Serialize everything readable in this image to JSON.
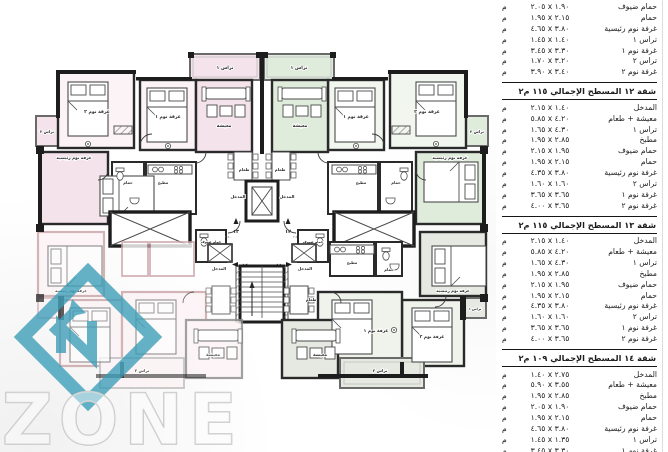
{
  "watermark": {
    "brand": "ZONE",
    "accent": "#3a9db8"
  },
  "plan": {
    "rooms": {
      "bed2": "غرفة نوم ٢",
      "bed1": "غرفة نوم ١",
      "master": "غرفة نوم رئيسية",
      "living": "معيشة",
      "dining": "طعام",
      "kitchen": "مطبخ",
      "bath": "حمام",
      "guest_bath": "حمام ضيوف",
      "entrance": "المدخل",
      "terrace1": "تراس ١",
      "terrace2": "تراس ٢"
    },
    "apartment_numbers": {
      "top_left": "١٣",
      "top_right": "١٢",
      "bottom_left": "١٤",
      "bottom_right": "١١"
    },
    "tiny_dims": {
      "a": "٤.٥٠",
      "b": "٢.٥٠"
    },
    "colors": {
      "pink": "#f4e3ea",
      "pink_light": "#fbf3f6",
      "green": "#dfecdc",
      "green_light": "#f1f6ef",
      "grey_green": "#e6e9e1",
      "grey_green_light": "#f0f2ec",
      "faint_pink": "#fcf3f5",
      "wall": "#222222"
    }
  },
  "table": {
    "unit": "م",
    "sections": [
      {
        "header": null,
        "rows": [
          {
            "label": "حمام ضيوف",
            "dim": "٢.٠٥ x ١.٩٠"
          },
          {
            "label": "حمام",
            "dim": "١.٩٥ x ٢.١٥"
          },
          {
            "label": "غرفة نوم رئيسية",
            "dim": "٤.٦٥ x ٣.٨٠"
          },
          {
            "label": "تراس ١",
            "dim": "١.٤٥ x ١.٤٠"
          },
          {
            "label": "غرفة نوم ١",
            "dim": "٣.٤٥ x ٣.٣٠"
          },
          {
            "label": "تراس ٢",
            "dim": "١.٧٠ x ٣.٢٠"
          },
          {
            "label": "غرفة نوم ٢",
            "dim": "٣.٩٠ x ٣.٤٠"
          }
        ]
      },
      {
        "header": "شقة ١٢ المسطح الإجمالي ١١٥ م٢",
        "rows": [
          {
            "label": "المدخل",
            "dim": "٢.١٥ x ١.٤٠"
          },
          {
            "label": "معيشة + طعام",
            "dim": "٥.٨٥ x ٤.٢٠"
          },
          {
            "label": "تراس ١",
            "dim": "١.٦٥ x ٤.٣٠"
          },
          {
            "label": "مطبخ",
            "dim": "١.٩٥ x ٢.٨٥"
          },
          {
            "label": "حمام ضيوف",
            "dim": "٢.١٥ x ١.٩٥"
          },
          {
            "label": "حمام",
            "dim": "١.٩٥ x ٢.١٥"
          },
          {
            "label": "غرفة نوم رئيسية",
            "dim": "٤.٣٥ x ٣.٨٠"
          },
          {
            "label": "تراس ٢",
            "dim": "١.٦٠ x ١.٦٠"
          },
          {
            "label": "غرفة نوم ١",
            "dim": "٣.٦٥ x ٣.٦٥"
          },
          {
            "label": "غرفة نوم ٢",
            "dim": "٤.٠٠ x ٣.٦٥"
          }
        ]
      },
      {
        "header": "شقة ١٣ المسطح الإجمالي ١١٥ م٢",
        "rows": [
          {
            "label": "المدخل",
            "dim": "٢.١٥ x ١.٤٠"
          },
          {
            "label": "معيشة + طعام",
            "dim": "٥.٨٥ x ٤.٢٠"
          },
          {
            "label": "تراس ١",
            "dim": "١.٦٥ x ٤.٣٠"
          },
          {
            "label": "مطبخ",
            "dim": "١.٩٥ x ٢.٨٥"
          },
          {
            "label": "حمام ضيوف",
            "dim": "٢.١٥ x ١.٩٥"
          },
          {
            "label": "حمام",
            "dim": "١.٩٥ x ٢.١٥"
          },
          {
            "label": "غرفة نوم رئيسية",
            "dim": "٤.٣٥ x ٣.٨٠"
          },
          {
            "label": "تراس ٢",
            "dim": "١.٦٠ x ١.٦٠"
          },
          {
            "label": "غرفة نوم ١",
            "dim": "٣.٦٥ x ٣.٦٥"
          },
          {
            "label": "غرفة نوم ٢",
            "dim": "٤.٠٠ x ٣.٦٥"
          }
        ]
      },
      {
        "header": "شقة ١٤ المسطح الإجمالي ١٠٩ م٢",
        "rows": [
          {
            "label": "المدخل",
            "dim": "١.٤٠ x ٢.٧٥"
          },
          {
            "label": "معيشة + طعام",
            "dim": "٥.٩٠ x ٣.٥٥"
          },
          {
            "label": "مطبخ",
            "dim": "١.٩٥ x ٢.٨٥"
          },
          {
            "label": "حمام ضيوف",
            "dim": "٢.٠٥ x ١.٩٠"
          },
          {
            "label": "حمام",
            "dim": "١.٩٥ x ٢.١٥"
          },
          {
            "label": "غرفة نوم رئيسية",
            "dim": "٤.٦٥ x ٣.٨٠"
          },
          {
            "label": "تراس ١",
            "dim": "١.٤٥ x ١.٣٥"
          },
          {
            "label": "غرفة نوم ١",
            "dim": "٣.٤٥ x ٣.٣٠"
          }
        ]
      }
    ]
  }
}
